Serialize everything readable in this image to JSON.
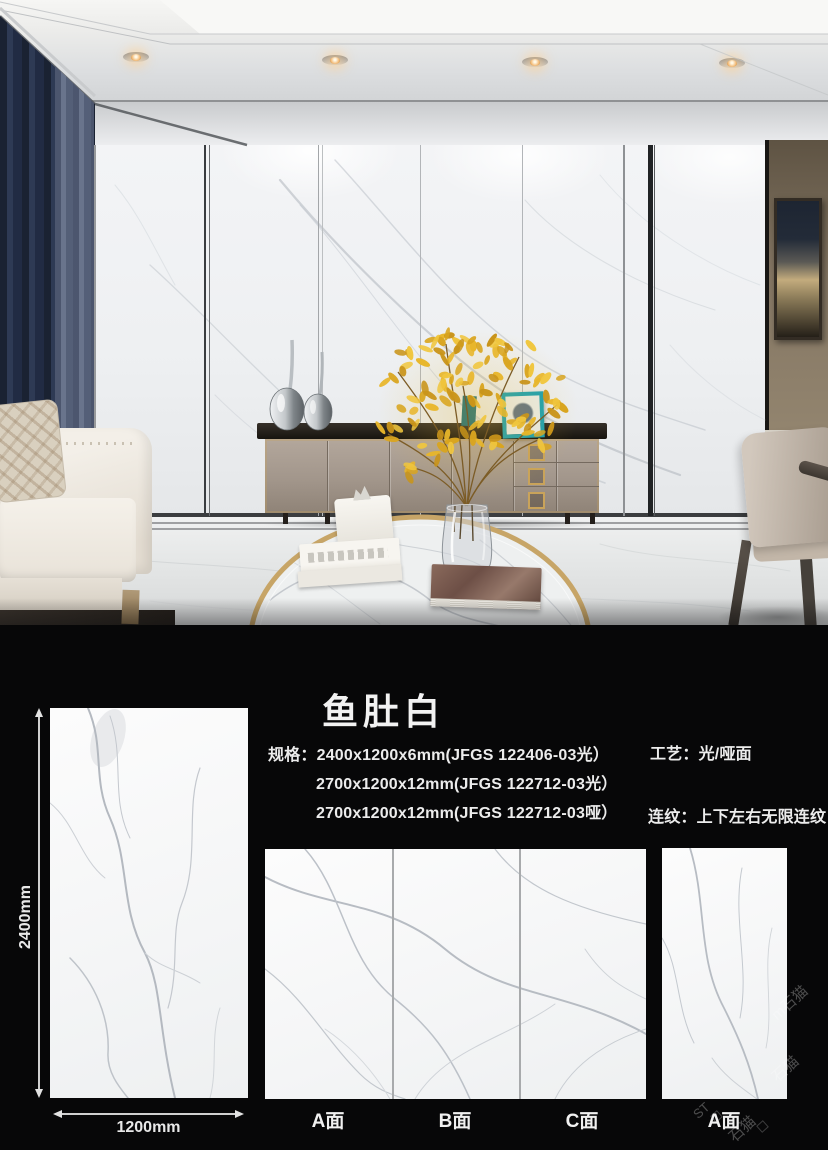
{
  "product": {
    "title": "鱼肚白",
    "spec_label": "规格：",
    "spec_lines": [
      "2400x1200x6mm(JFGS 122406-03光）",
      "2700x1200x12mm(JFGS 122712-03光）",
      "2700x1200x12mm(JFGS 122712-03哑）"
    ],
    "process_label": "工艺：",
    "process_value": "光/哑面",
    "pattern_label": "连纹：",
    "pattern_value": "上下左右无限连纹",
    "slab_height": "2400mm",
    "slab_width": "1200mm",
    "panel_labels": [
      "A面",
      "B面",
      "C面",
      "A面"
    ],
    "watermark_fragments": [
      "m石猫",
      "石猫",
      "ST",
      "石猫"
    ]
  },
  "colors": {
    "accent_gold": "#c9a35a",
    "marble_vein": "#b6bcc4",
    "curtain_navy": "#273149",
    "teal_frame": "#17a0b4",
    "flower_yellow": "#e6b52c",
    "text_white": "#f2f2f2",
    "background_black": "#070708"
  }
}
